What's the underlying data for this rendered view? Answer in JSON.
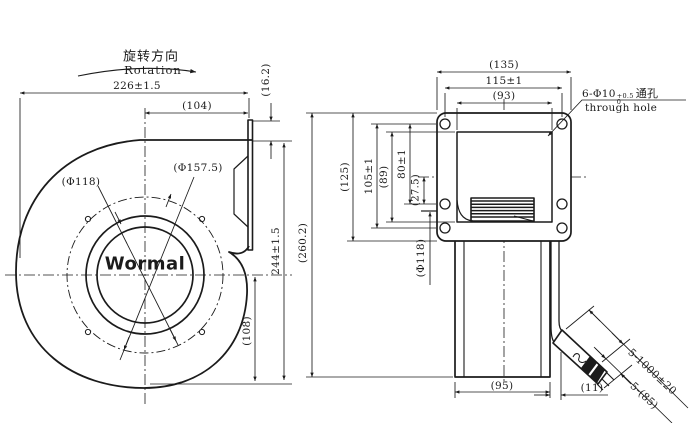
{
  "colors": {
    "background": "#ffffff",
    "ink": "#1b1b1b"
  },
  "left_view": {
    "rotation_cn": "旋转方向",
    "rotation_en": "Rotation",
    "logo": "Wormal",
    "dim_total_width": "226±1.5",
    "dim_flange_width": "(104)",
    "dim_flange_offset": "(16.2)",
    "dim_total_height": "244±1.5",
    "dim_center_to_bottom": "(108)",
    "dia_inlet": "(Φ118)",
    "dia_bolt_circle": "(Φ157.5)"
  },
  "right_view": {
    "dim_flange_width": "(135)",
    "dim_hole_span_h": "115±1",
    "dim_outlet_width": "(93)",
    "dim_total_height": "(260.2)",
    "dim_flange_height": "(125)",
    "dim_hole_span_v": "105±1",
    "dim_outlet_height": "(89)",
    "dim_hole_span_upper": "80±1",
    "dim_center_to_hole": "(27.5)",
    "dia_inlet": "(Φ118)",
    "dim_body_width": "(95)",
    "dim_cable_offset": "(11)",
    "dim_cable_length": "5-1000±20",
    "dim_cable_tail": "5-(85)",
    "hole_note": {
      "main": "6-Φ10",
      "tol_plus": "+0.5",
      "tol_minus": "0",
      "cn": "通孔",
      "en": "through hole"
    }
  }
}
